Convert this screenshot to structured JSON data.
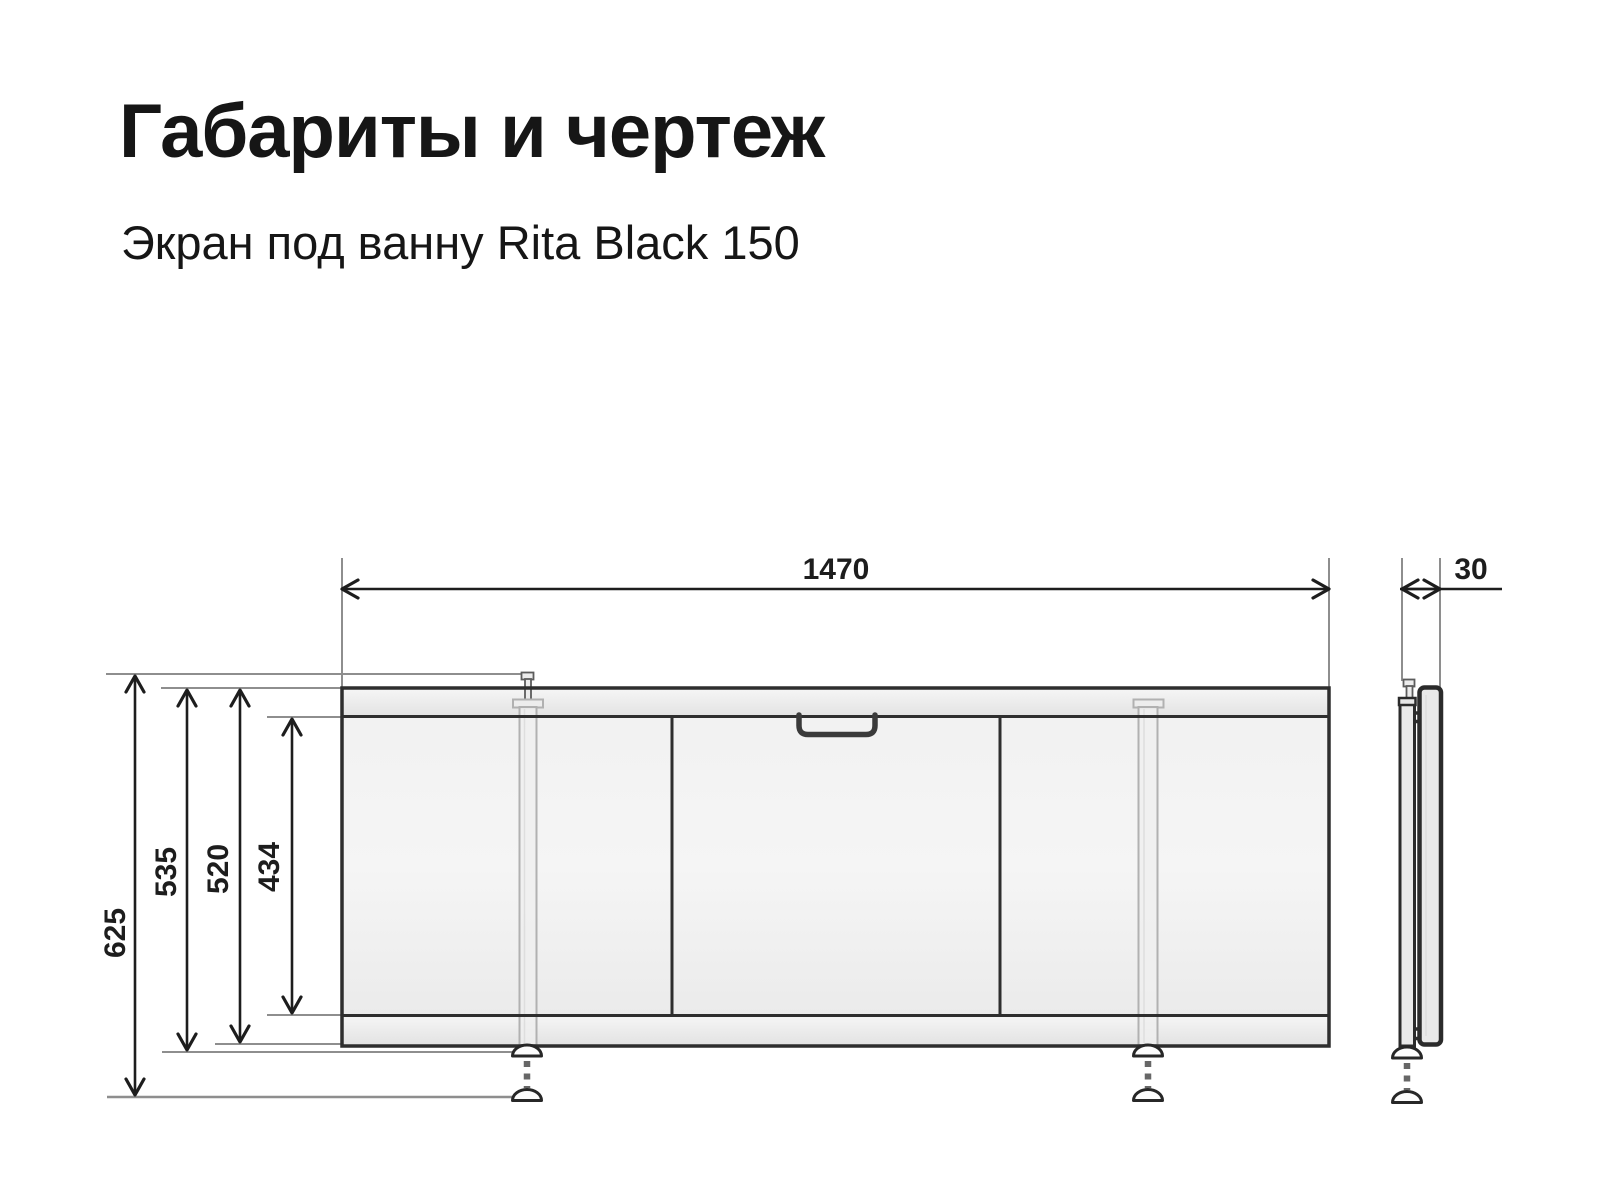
{
  "theme": {
    "bg": "#ffffff",
    "text": "#161616",
    "ink": "#1d1d1d",
    "line-gray": "#8e8e8e",
    "panel-border": "#2e2e2e",
    "leg-gray": "#b1b1b1",
    "handle": "#3a3a3a",
    "foot-fill": "#fcfcfc",
    "dash-gray": "#676767"
  },
  "header": {
    "title": "Габариты и чертеж",
    "subtitle": "Экран под ванну Rita Black 150"
  },
  "drawing": {
    "dimensions": {
      "width": "1470",
      "depth": "30",
      "total_height": "625",
      "height_with_feet": "535",
      "panel_height": "520",
      "inner_height": "434"
    }
  }
}
